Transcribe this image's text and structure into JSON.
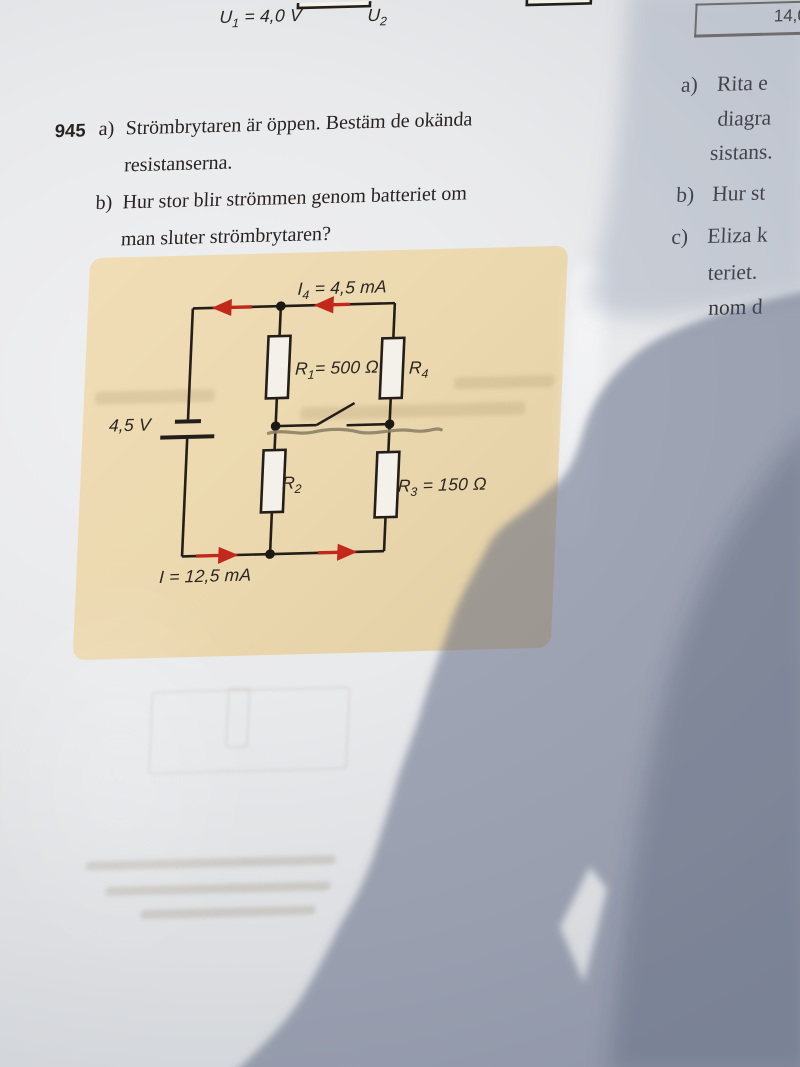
{
  "page": {
    "top_fragment": {
      "u1": {
        "base": "U",
        "sub": "1",
        "rest": " = 4,0 V"
      },
      "u2": {
        "base": "U",
        "sub": "2",
        "rest": ""
      }
    },
    "header_table": {
      "value": "14,0"
    },
    "problem": {
      "number": "945",
      "part_a_label": "a)",
      "part_a_lines": [
        "Strömbrytaren är öppen. Bestäm de okända",
        "resistanserna."
      ],
      "part_b_label": "b)",
      "part_b_lines": [
        "Hur stor blir strömmen genom batteriet om",
        "man sluter strömbrytaren?"
      ]
    },
    "circuit": {
      "current_top": {
        "base": "I",
        "sub": "4",
        "rest": " = 4,5 mA"
      },
      "r1": {
        "base": "R",
        "sub": "1",
        "rest": "= 500 Ω"
      },
      "r4": {
        "base": "R",
        "sub": "4",
        "rest": ""
      },
      "battery_voltage": "4,5 V",
      "r2": {
        "base": "R",
        "sub": "2",
        "rest": ""
      },
      "r3": {
        "base": "R",
        "sub": "3",
        "rest": " = 150 Ω"
      },
      "current_bottom": {
        "base": "I",
        "sub": "",
        "rest": " = 12,5 mA"
      }
    },
    "right_column": {
      "item_a_label": "a)",
      "item_a_line1": "Rita e",
      "item_a_line2": "diagra",
      "item_a_line3": "sistans.",
      "item_b_label": "b)",
      "item_b_line1": "Hur st",
      "item_c_label": "c)",
      "item_c_line1": "Eliza k",
      "item_c_line2": "teriet.",
      "item_c_line3": "nom d"
    },
    "colors": {
      "panel_beige": "#ecd9b0",
      "ink": "#241e18",
      "arrow_red": "#c2291c",
      "shadow_blue": "#56617d"
    }
  }
}
